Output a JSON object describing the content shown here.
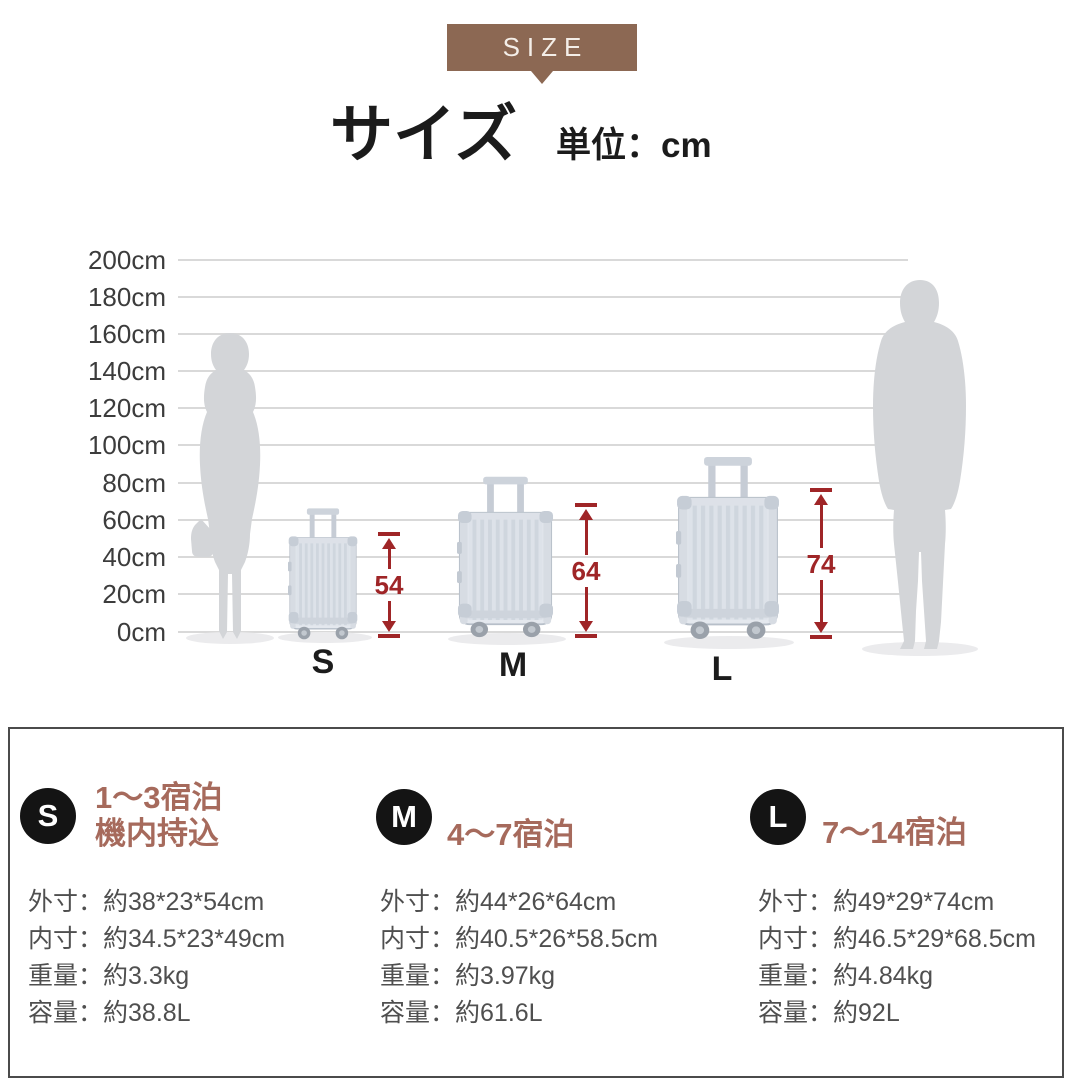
{
  "header": {
    "tab_label": "SIZE",
    "title": "サイズ",
    "unit": "単位：cm"
  },
  "size_chart": {
    "axis_ticks": [
      "200cm",
      "180cm",
      "160cm",
      "140cm",
      "120cm",
      "100cm",
      "80cm",
      "60cm",
      "40cm",
      "20cm",
      "0cm"
    ],
    "sizes": [
      {
        "label": "S",
        "height_cm": "54"
      },
      {
        "label": "M",
        "height_cm": "64"
      },
      {
        "label": "L",
        "height_cm": "74"
      }
    ]
  },
  "chart_data": {
    "type": "bar",
    "title": "サイズ（単位：cm）",
    "categories": [
      "S",
      "M",
      "L"
    ],
    "values": [
      54,
      64,
      74
    ],
    "ylabel": "cm",
    "ylim": [
      0,
      200
    ],
    "tick_step": 20,
    "annotations": [
      "54",
      "64",
      "74"
    ]
  },
  "info_panel": {
    "sections": [
      {
        "badge": "S",
        "heading_lines": [
          "1～3宿泊",
          "機内持込"
        ],
        "rows": [
          {
            "label": "外寸：",
            "value": "約38*23*54cm"
          },
          {
            "label": "内寸：",
            "value": "約34.5*23*49cm"
          },
          {
            "label": "重量：",
            "value": "約3.3kg"
          },
          {
            "label": "容量：",
            "value": "約38.8L"
          }
        ]
      },
      {
        "badge": "M",
        "heading_lines": [
          "4～7宿泊"
        ],
        "rows": [
          {
            "label": "外寸：",
            "value": "約44*26*64cm"
          },
          {
            "label": "内寸：",
            "value": "約40.5*26*58.5cm"
          },
          {
            "label": "重量：",
            "value": "約3.97kg"
          },
          {
            "label": "容量：",
            "value": "約61.6L"
          }
        ]
      },
      {
        "badge": "L",
        "heading_lines": [
          "7～14宿泊"
        ],
        "rows": [
          {
            "label": "外寸：",
            "value": "約49*29*74cm"
          },
          {
            "label": "内寸：",
            "value": "約46.5*29*68.5cm"
          },
          {
            "label": "重量：",
            "value": "約4.84kg"
          },
          {
            "label": "容量：",
            "value": "約92L"
          }
        ]
      }
    ]
  },
  "colors": {
    "tab_brown": "#8c6853",
    "accent_red": "#9f2527",
    "heading_brown": "#a66a5c",
    "badge_black": "#141414",
    "gridline_gray": "#d9d9d9",
    "silhouette_gray": "#d3d5d8"
  }
}
